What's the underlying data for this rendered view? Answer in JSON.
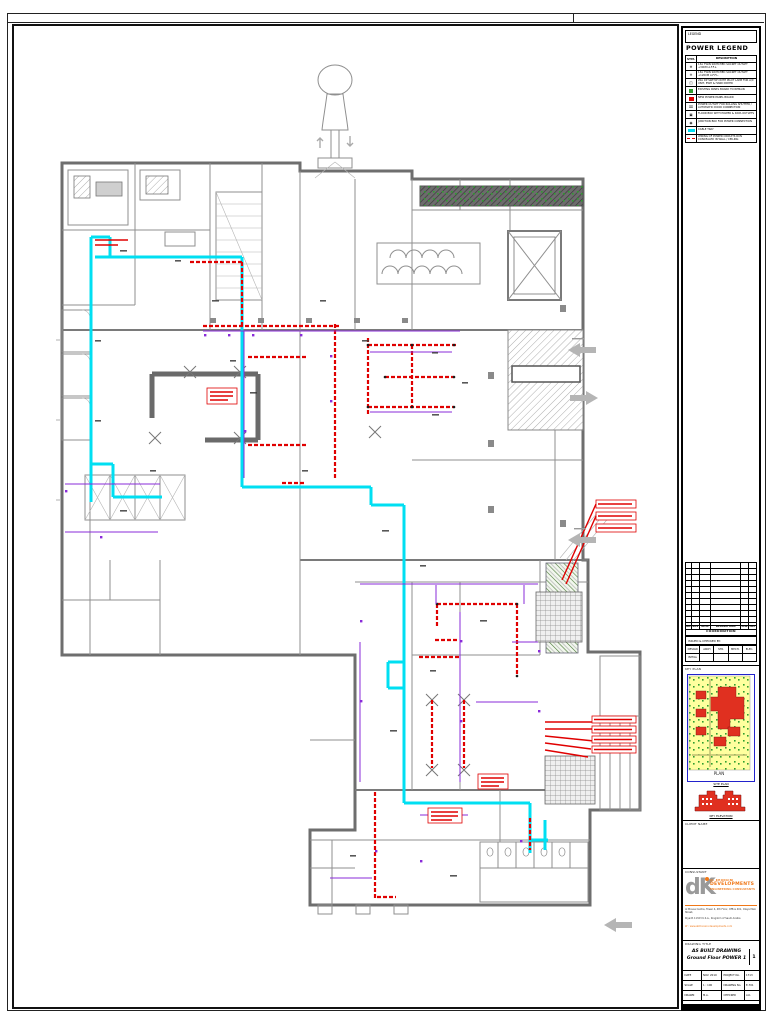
{
  "colors": {
    "cyan": "#00dff2",
    "red": "#e00000",
    "purple": "#8a2bd9",
    "green": "#2f9e2f",
    "wall": "#787878",
    "orange": "#f07818",
    "kpyellow": "#ffff9e",
    "kpblue": "#2222cc",
    "sitered": "#e03020"
  },
  "sheet": {
    "legend_box_label": "LEGEND",
    "legend": {
      "title": "POWER LEGEND",
      "header": {
        "symbol": "SYM.",
        "description": "DESCRIPTION"
      },
      "rows": [
        {
          "sym": "⊕",
          "desc": "13A TWIN SWITCHED SOCKET OUTLET +30CM A.F.F.L."
        },
        {
          "sym": "⊖",
          "desc": "13A TWIN SWITCHED SOCKET OUTLET +120CM A.F.F.L."
        },
        {
          "sym": "◫",
          "desc": "20A DP SWITCH WITH PILOT LAMP FOR A/C UNIT, EWH & HAND DRYER"
        },
        {
          "sym": "",
          "desc": "EXISTING PANEL BOARD TO REMAIN"
        },
        {
          "sym": "",
          "desc": "NEW POWER PANEL BOARD"
        },
        {
          "sym": "⌧",
          "desc": "POWER OUTLET FOR ROLLING SHUTTER / AUTOMATIC DOOR CONNECTION"
        },
        {
          "sym": "▣",
          "desc": "FLOOR BOX WITH POWER & DATA OUTLETS"
        },
        {
          "sym": "◉",
          "desc": "JUNCTION BOX FOR POWER CONNECTION"
        },
        {
          "sym": "",
          "desc": "CABLE TRAY"
        },
        {
          "sym": "",
          "desc": "WIRING OF POWER CIRCUITS RUN CONCEALED IN WALL / CEILING"
        }
      ]
    },
    "revision_table": {
      "headers": [
        "NO",
        "REV",
        "DATE",
        "DESCRIPTION",
        "CHK",
        "APP"
      ]
    },
    "coordination": {
      "title": "COORDINATION",
      "issued_label": "ISSUED & CHECKED BY:",
      "columns": [
        "DESIGN",
        "ARCH",
        "STR.",
        "MECH.",
        "ELEC."
      ],
      "row_label": "INITIAL"
    },
    "key_plan": {
      "label": "KEY PLAN",
      "site_plan_caption": "SITE PLAN",
      "elevation_caption": "KEY ELEVATION"
    },
    "client": {
      "label": "CLIENT NAME"
    },
    "consultant": {
      "label": "CONSULTANT",
      "logo_mark": "dK",
      "name_line1": "AL KHONAINI",
      "name_line2": "DEVELOPMENTS",
      "name_line3": "ENGINEERING CONSULTANTS",
      "address_line1": "Al Mousa Centre, Tower 4, 4th Floor, Office 401, Olaya Main Street,",
      "address_line2": "Riyadh 11323 K.S.A., Kingdom of Saudi Arabia",
      "address_line3": "W : www.alkhonaini-developments.com"
    },
    "drawing_title": {
      "label": "DRAWING TITLE",
      "line1": "AS BUILT DRAWING",
      "line2": "Ground Floor POWER 1",
      "sheet_tag": "1"
    },
    "info_table": {
      "rows": [
        [
          "DATE",
          "NOV. 2019",
          "PROJECT No.",
          "1713"
        ],
        [
          "SCALE",
          "1 : 100",
          "DRAWING No.",
          "E-701"
        ],
        [
          "DRAWN",
          "M.A.",
          "CHECKED",
          "A.K."
        ]
      ]
    }
  }
}
